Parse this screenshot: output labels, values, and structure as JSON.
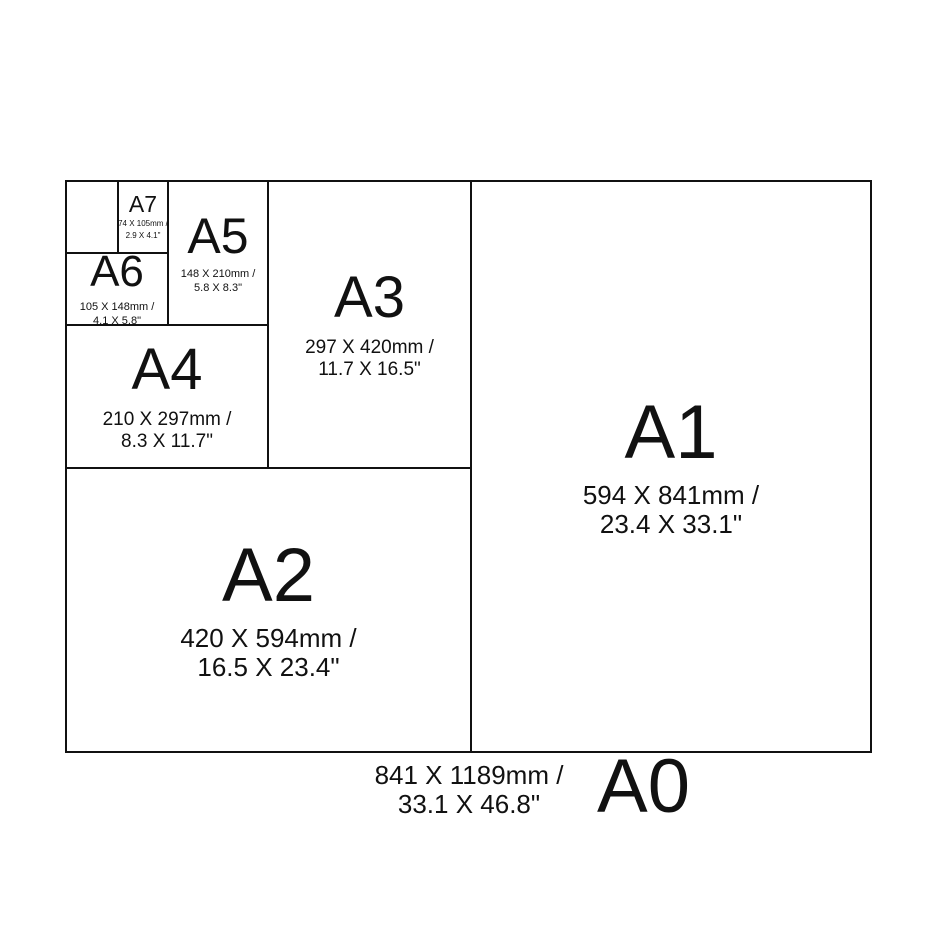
{
  "sizes": {
    "a0": {
      "label": "A0",
      "mm": "841 X 1189mm /",
      "inches": "33.1 X 46.8\""
    },
    "a1": {
      "label": "A1",
      "mm": "594 X 841mm /",
      "inches": "23.4 X 33.1\""
    },
    "a2": {
      "label": "A2",
      "mm": "420 X 594mm /",
      "inches": "16.5 X 23.4\""
    },
    "a3": {
      "label": "A3",
      "mm": "297 X 420mm /",
      "inches": "11.7 X 16.5\""
    },
    "a4": {
      "label": "A4",
      "mm": "210 X 297mm /",
      "inches": "8.3 X 11.7\""
    },
    "a5": {
      "label": "A5",
      "mm": "148 X 210mm /",
      "inches": "5.8 X 8.3\""
    },
    "a6": {
      "label": "A6",
      "mm": "105 X 148mm /",
      "inches": "4.1 X 5.8\""
    },
    "a7": {
      "label": "A7",
      "mm": "74 X 105mm /",
      "inches": "2.9 X 4.1\""
    }
  },
  "colors": {
    "line": "#111111",
    "text": "#111111",
    "background": "#ffffff"
  }
}
